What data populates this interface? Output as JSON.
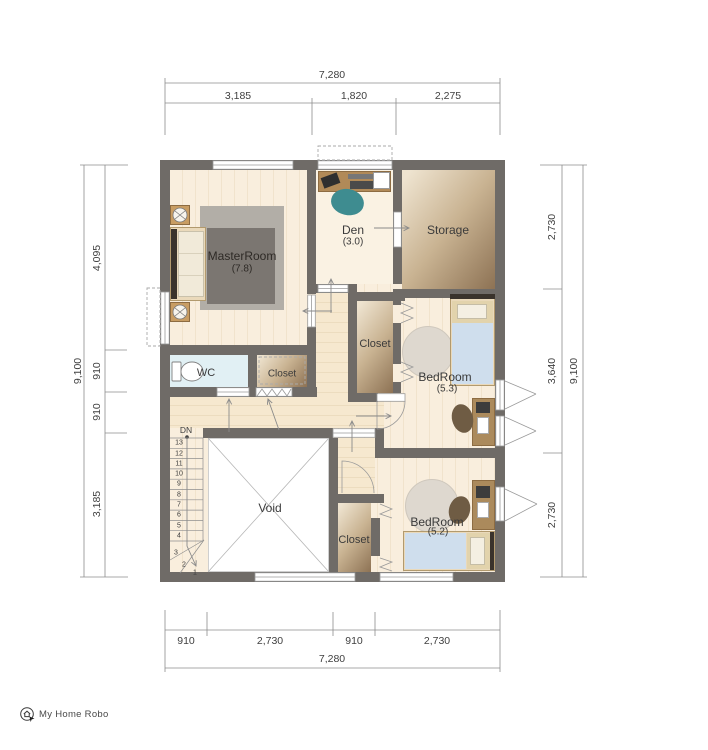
{
  "colors": {
    "wall": "#6f6b67",
    "floor-light": "#f9eedd",
    "floor-stripe": "#f1e3cc",
    "hall-light": "#f6e8cf",
    "hall-stripe": "#ecdcbf",
    "den-floor": "#faf2e3",
    "wc-floor": "#e1f0f4",
    "rug-outer": "#b2aea7",
    "rug-inner": "#7b7671",
    "round-rug": "#ded8cf",
    "bed-frame": "#ead9ba",
    "blanket": "#cfdeed",
    "headboard": "#3a332c",
    "desk": "#ab8a5c",
    "chair-teal": "#3e8c90",
    "chair-brown": "#6f5c44",
    "line": "#9a9a9a",
    "text": "#3b3b3b"
  },
  "rooms": {
    "master": {
      "name": "MasterRoom",
      "area": "(7.8)"
    },
    "den": {
      "name": "Den",
      "area": "(3.0)"
    },
    "storage": {
      "name": "Storage"
    },
    "wc": {
      "name": "WC"
    },
    "closet_master": {
      "name": "Closet"
    },
    "closet_b53": {
      "name": "Closet"
    },
    "closet_b52": {
      "name": "Closet"
    },
    "bedroom_53": {
      "name": "BedRoom",
      "area": "(5.3)"
    },
    "bedroom_52": {
      "name": "BedRoom",
      "area": "(5.2)"
    },
    "void": {
      "name": "Void"
    }
  },
  "stairs": {
    "label": "DN",
    "steps": [
      "13",
      "12",
      "11",
      "10",
      "9",
      "8",
      "7",
      "6",
      "5",
      "4",
      "3",
      "2",
      "1"
    ]
  },
  "dims": {
    "top": {
      "overall": "7,280",
      "segments": [
        "3,185",
        "1,820",
        "2,275"
      ]
    },
    "bottom": {
      "overall": "7,280",
      "segments": [
        "910",
        "2,730",
        "910",
        "2,730"
      ]
    },
    "left": {
      "overall": "9,100",
      "segments": [
        "4,095",
        "910",
        "910",
        "3,185"
      ]
    },
    "right": {
      "overall": "9,100",
      "segments": [
        "2,730",
        "3,640",
        "2,730"
      ]
    }
  },
  "logo": {
    "text": "My Home Robo"
  }
}
